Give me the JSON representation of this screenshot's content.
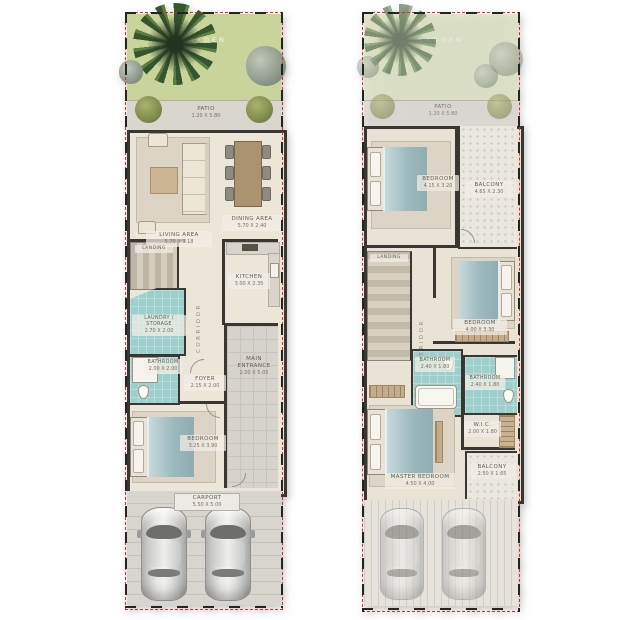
{
  "palette": {
    "plot_line": "#c3372f",
    "wall": "#3a3733",
    "floor": "#ece6d9",
    "garden_green": "#c9d49a",
    "garden_green_faded": "#dde3c3",
    "wet_area_teal": "#9dcfcd",
    "paving_gray": "#d8d5ce",
    "label_text": "#655d50"
  },
  "ground_floor": {
    "garden": {
      "label": "GARDEN"
    },
    "patio": {
      "label": "PATIO",
      "dims": "1.20 X 5.80"
    },
    "living_area": {
      "label": "LIVING AREA",
      "dims": "5.70 X 3.18"
    },
    "dining_area": {
      "label": "DINING AREA",
      "dims": "5.70 X 2.40"
    },
    "landing": {
      "label": "LANDING"
    },
    "laundry_storage": {
      "label": "LAUNDRY / STORAGE",
      "dims": "2.70 X 2.00"
    },
    "corridor": {
      "label": "CORRIDOR"
    },
    "kitchen": {
      "label": "KITCHEN",
      "dims": "3.00 X 2.35"
    },
    "bathroom": {
      "label": "BATHROOM",
      "dims": "2.00 X 2.00"
    },
    "foyer": {
      "label": "FOYER",
      "dims": "2.15 X 2.00"
    },
    "main_entrance": {
      "label": "MAIN ENTRANCE",
      "dims": "2.00 X 5.05"
    },
    "bedroom": {
      "label": "BEDROOM",
      "dims": "3.25 X 3.90"
    },
    "carport": {
      "label": "CARPORT",
      "dims": "5.50 X 5.00"
    }
  },
  "first_floor": {
    "garden": {
      "label": "GARDEN"
    },
    "patio": {
      "label": "PATIO",
      "dims": "1.20 X 5.80"
    },
    "bedroom_2": {
      "label": "BEDROOM",
      "dims": "4.15 X 3.20"
    },
    "balcony_front": {
      "label": "BALCONY",
      "dims": "4.65 X 2.30"
    },
    "landing": {
      "label": "LANDING"
    },
    "corridor": {
      "label": "CORRIDOR"
    },
    "bedroom_3": {
      "label": "BEDROOM",
      "dims": "4.00 X 3.30"
    },
    "bathroom_2": {
      "label": "BATHROOM",
      "dims": "2.40 X 1.80"
    },
    "bathroom_3": {
      "label": "BATHROOM",
      "dims": "2.40 X 1.80"
    },
    "wic": {
      "label": "W.I.C.",
      "dims": "2.00 X 1.80"
    },
    "master_bedroom": {
      "label": "MASTER BEDROOM",
      "dims": "4.50 X 4.00"
    },
    "balcony_rear": {
      "label": "BALCONY",
      "dims": "2.50 X 1.65"
    }
  }
}
